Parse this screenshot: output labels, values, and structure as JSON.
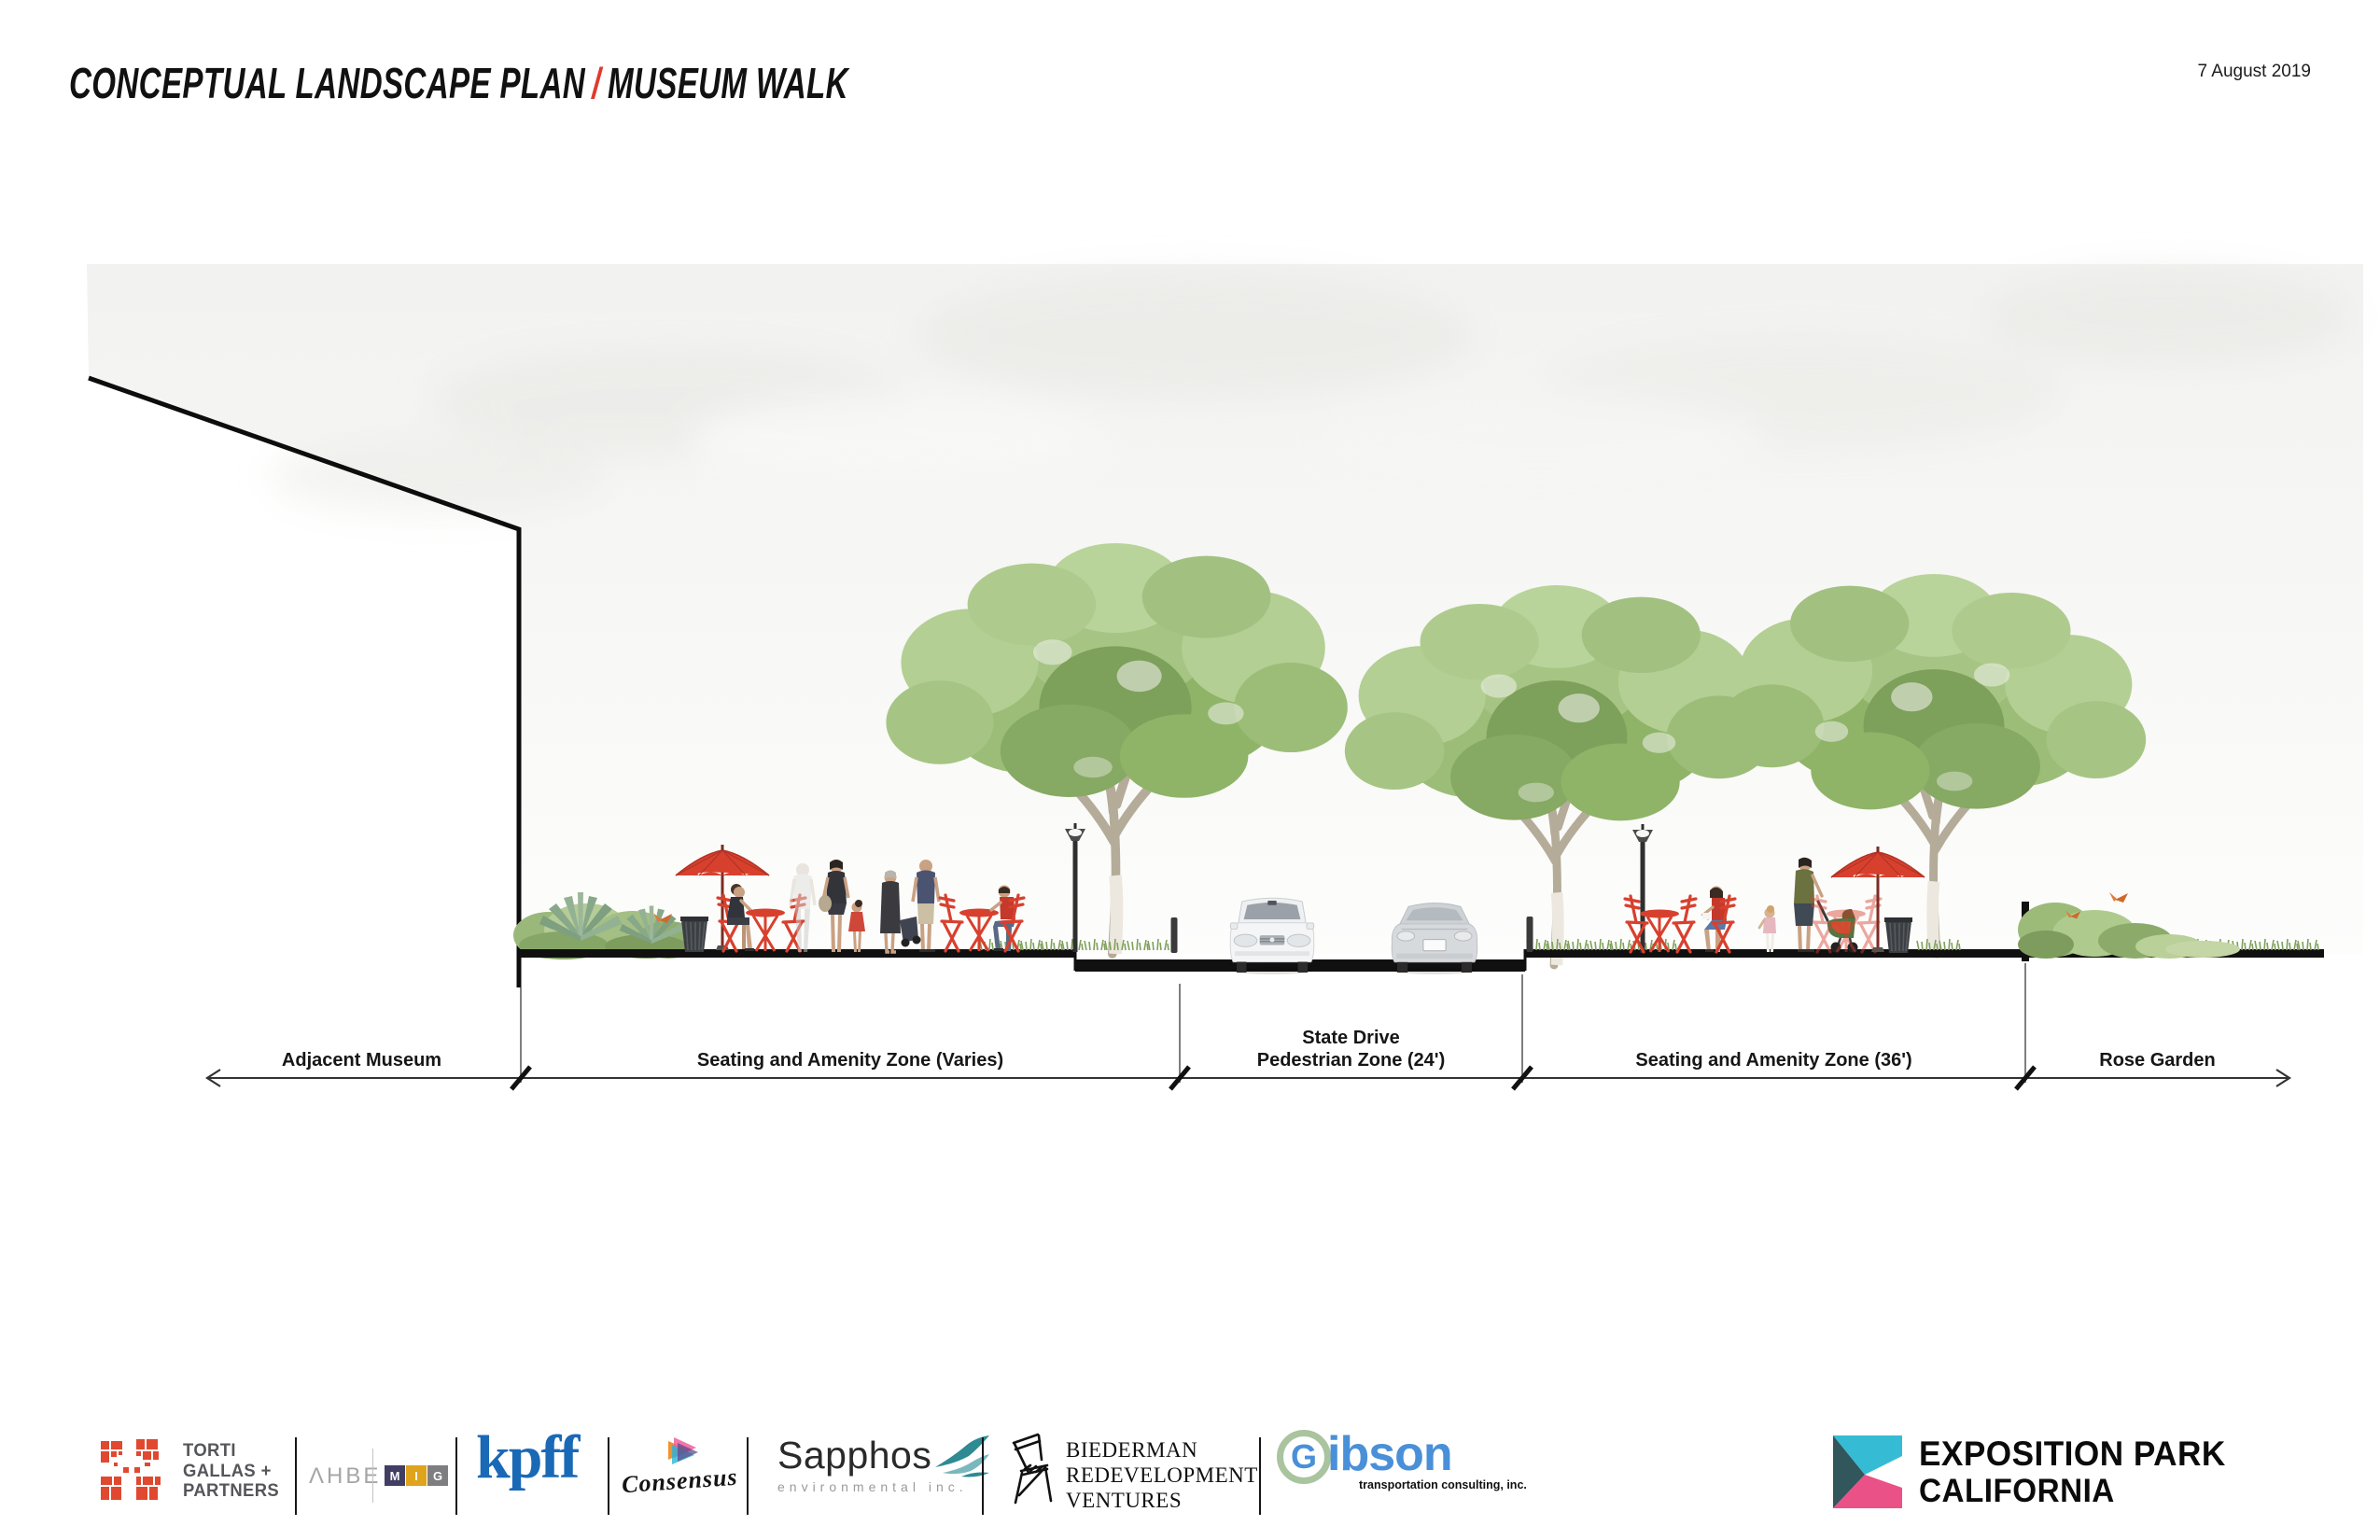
{
  "header": {
    "title_main": "CONCEPTUAL LANDSCAPE PLAN",
    "title_separator": "/",
    "title_sub": "MUSEUM WALK",
    "date": "7 August 2019"
  },
  "diagram": {
    "zones": [
      {
        "lines": [
          "Adjacent Museum"
        ]
      },
      {
        "lines": [
          "Seating and Amenity Zone (Varies)"
        ]
      },
      {
        "lines": [
          "State Drive",
          "Pedestrian Zone (24')"
        ]
      },
      {
        "lines": [
          "Seating and Amenity Zone (36')"
        ]
      },
      {
        "lines": [
          "Rose Garden"
        ]
      }
    ],
    "icons": {
      "trees": "street-tree-icon",
      "lamps": "street-lamp-icon",
      "umbrellas": "cafe-umbrella-icon",
      "furniture": "cafe-table-and-chairs-icon",
      "trash": "trash-can-icon",
      "car_front": "car-front-icon",
      "car_rear": "car-rear-icon",
      "people": "pedestrian-figures-icon",
      "stroller": "stroller-icon",
      "planting": "agave-shrub-planting-icon",
      "bird": "bird-icon"
    },
    "colors": {
      "furniture_red": "#D8402E",
      "foliage_green": "#8FB468",
      "ground_black": "#111111",
      "sky_gray": "#F3F3F1"
    }
  },
  "logos": {
    "torti": {
      "lines": [
        "TORTI",
        "GALLAS +",
        "PARTNERS"
      ],
      "mosaic_red": "#E0492F"
    },
    "ahbe": {
      "label": "ΛHBE"
    },
    "mig": {
      "letters": [
        "M",
        "I",
        "G"
      ],
      "colors": [
        "#403E63",
        "#DFA31C",
        "#7D7D82"
      ]
    },
    "kpff": {
      "label": "kpff",
      "color": "#1A69B6"
    },
    "consensus": {
      "label": "Consensus"
    },
    "sapphos": {
      "label": "Sapphos",
      "subline": "environmental inc.",
      "teal": "#2E8A93"
    },
    "biederman": {
      "lines": [
        "BIEDERMAN",
        "REDEVELOPMENT",
        "VENTURES"
      ]
    },
    "gibson": {
      "g": "G",
      "rest": "ibson",
      "subline": "transportation consulting, inc.",
      "blue": "#4A90D8"
    }
  },
  "brand": {
    "line1": "EXPOSITION PARK",
    "line2": "CALIFORNIA",
    "mark_colors": {
      "cyan": "#35BCD4",
      "teal": "#31565C",
      "pink": "#EA5187"
    }
  }
}
